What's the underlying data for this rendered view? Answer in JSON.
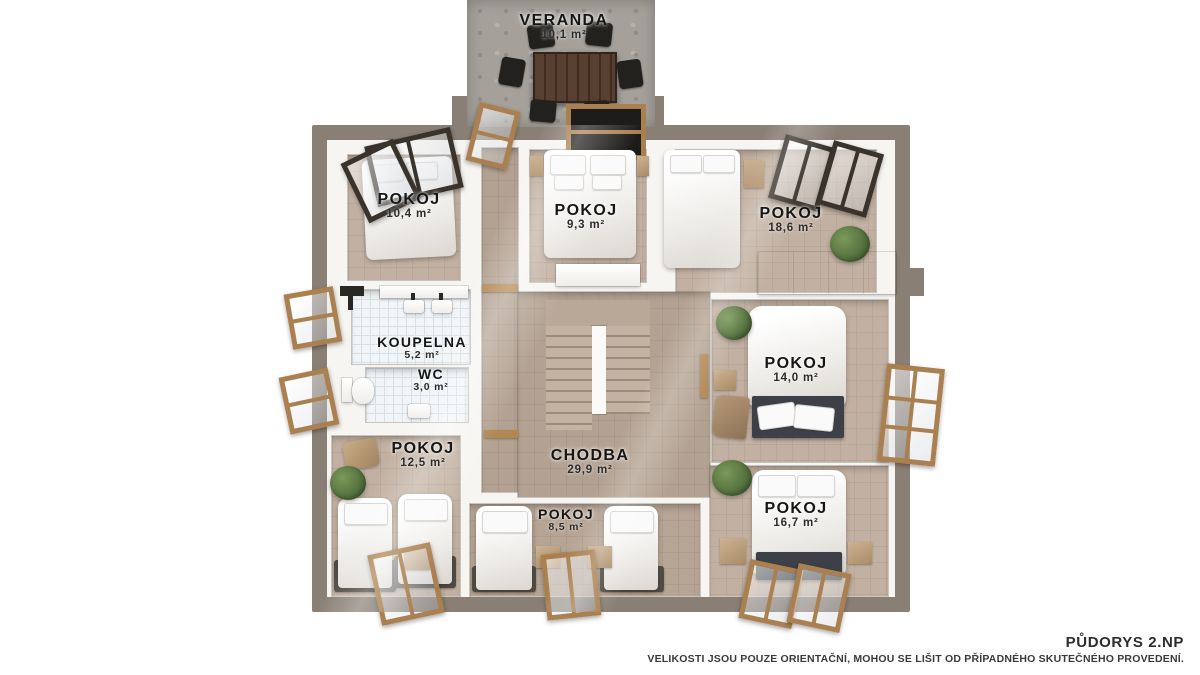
{
  "footer": {
    "title": "PŮDORYS 2.NP",
    "disclaimer": "VELIKOSTI JSOU POUZE ORIENTAČNÍ, MOHOU SE LIŠIT OD PŘÍPADNÉHO SKUTEČNÉHO PROVEDENÍ."
  },
  "rooms": {
    "veranda": {
      "name": "VERANDA",
      "area": "10,1 m²"
    },
    "pokoj_top_left": {
      "name": "POKOJ",
      "area": "10,4 m²"
    },
    "pokoj_top_mid": {
      "name": "POKOJ",
      "area": "9,3 m²"
    },
    "pokoj_top_right": {
      "name": "POKOJ",
      "area": "18,6 m²"
    },
    "koupelna": {
      "name": "KOUPELNA",
      "area": "5,2 m²"
    },
    "wc": {
      "name": "WC",
      "area": "3,0 m²"
    },
    "pokoj_mid_right": {
      "name": "POKOJ",
      "area": "14,0 m²"
    },
    "pokoj_bottom_left": {
      "name": "POKOJ",
      "area": "12,5 m²"
    },
    "chodba": {
      "name": "CHODBA",
      "area": "29,9 m²"
    },
    "pokoj_bottom_mid": {
      "name": "POKOJ",
      "area": "8,5 m²"
    },
    "pokoj_bottom_right": {
      "name": "POKOJ",
      "area": "16,7 m²"
    }
  },
  "colors": {
    "background": "#ffffff",
    "outer_wall": "#897f75",
    "room_floor": "#c2b1a2",
    "corridor_floor": "#b3a292",
    "bathroom_tile": "#f2f5f7",
    "wood_frame": "#ab8050",
    "dark_window_frame": "#3a332c",
    "dark_furniture": "#23211e",
    "bed_white": "#f4f2ef",
    "plant_green": "#54713d",
    "label_text": "#161616"
  }
}
